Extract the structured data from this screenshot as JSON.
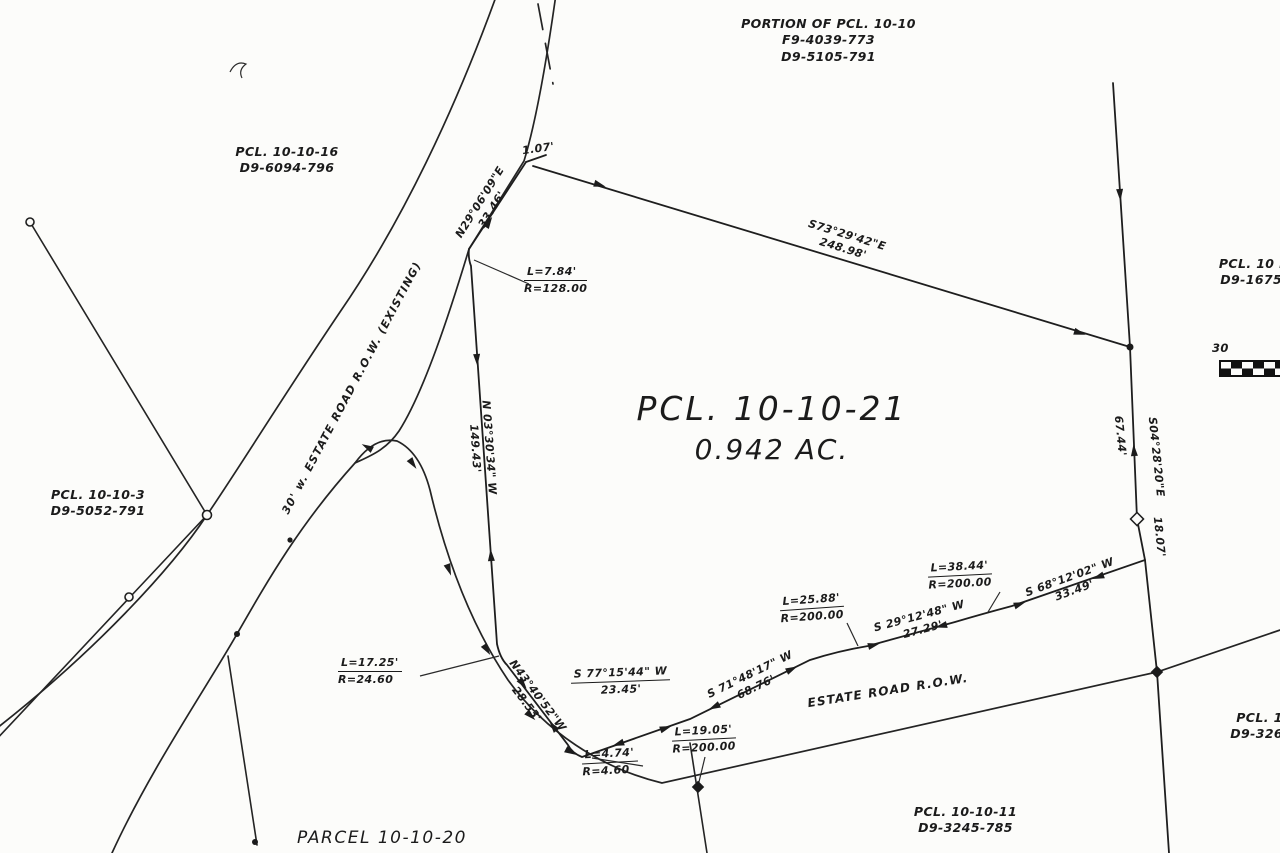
{
  "parcels": {
    "portion": {
      "l1": "PORTION OF PCL. 10-10",
      "l2": "F9-4039-773",
      "l3": "D9-5105-791"
    },
    "pcl_10_10_16": {
      "l1": "PCL. 10-10-16",
      "l2": "D9-6094-796"
    },
    "pcl_10_10_3": {
      "l1": "PCL. 10-10-3",
      "l2": "D9-5052-791"
    },
    "pcl_10_right": {
      "l1": "PCL. 10 R",
      "l2": "D9-1675-"
    },
    "main": {
      "l1": "PCL. 10-10-21",
      "l2": "0.942 AC."
    },
    "pcl_10_10_11": {
      "l1": "PCL. 10-10-11",
      "l2": "D9-3245-785"
    },
    "parcel_10_10_20": {
      "l1": "PARCEL 10-10-20"
    },
    "pcl_10_bottom_right": {
      "l1": "PCL. 10",
      "l2": "D9-3265-"
    }
  },
  "roads": {
    "estate_road_main": "30' w. ESTATE ROAD R.O.W. (EXISTING)",
    "estate_road_branch": "ESTATE ROAD R.O.W."
  },
  "bearings": {
    "n29": {
      "bearing": "N29°06'09\"E",
      "dist": "33.46'"
    },
    "s73": {
      "bearing": "S73°29'42\"E",
      "dist": "248.98'"
    },
    "n03": {
      "bearing": "N 03°30'34\" W",
      "dist": "149.43'"
    },
    "s04": {
      "bearing": "S04°28'20\"E"
    },
    "d18": {
      "dist": "18.07'"
    },
    "d67": {
      "dist": "67.44'"
    },
    "s68": {
      "bearing": "S 68°12'02\" W",
      "dist": "33.49'"
    },
    "s29": {
      "bearing": "S 29°12'48\" W",
      "dist": "27.29'"
    },
    "s71": {
      "bearing": "S 71°48'17\" W",
      "dist": "68.76'"
    },
    "s77": {
      "bearing": "S 77°15'44\" W",
      "dist": "23.45'"
    },
    "n43": {
      "bearing": "N43°40'52\"W",
      "dist": "28.53'"
    },
    "d107": {
      "dist": "1.07'"
    }
  },
  "curves": {
    "c1": {
      "l": "L=7.84'",
      "r": "R=128.00"
    },
    "c2": {
      "l": "L=17.25'",
      "r": "R=24.60"
    },
    "c3": {
      "l": "L=4.74'",
      "r": "R=4.60"
    },
    "c4": {
      "l": "L=19.05'",
      "r": "R=200.00"
    },
    "c5": {
      "l": "L=25.88'",
      "r": "R=200.00"
    },
    "c6": {
      "l": "L=38.44'",
      "r": "R=200.00"
    }
  },
  "scale": {
    "label": "30"
  },
  "colors": {
    "ink": "#1b1b1b",
    "paper": "#fcfcfa"
  }
}
